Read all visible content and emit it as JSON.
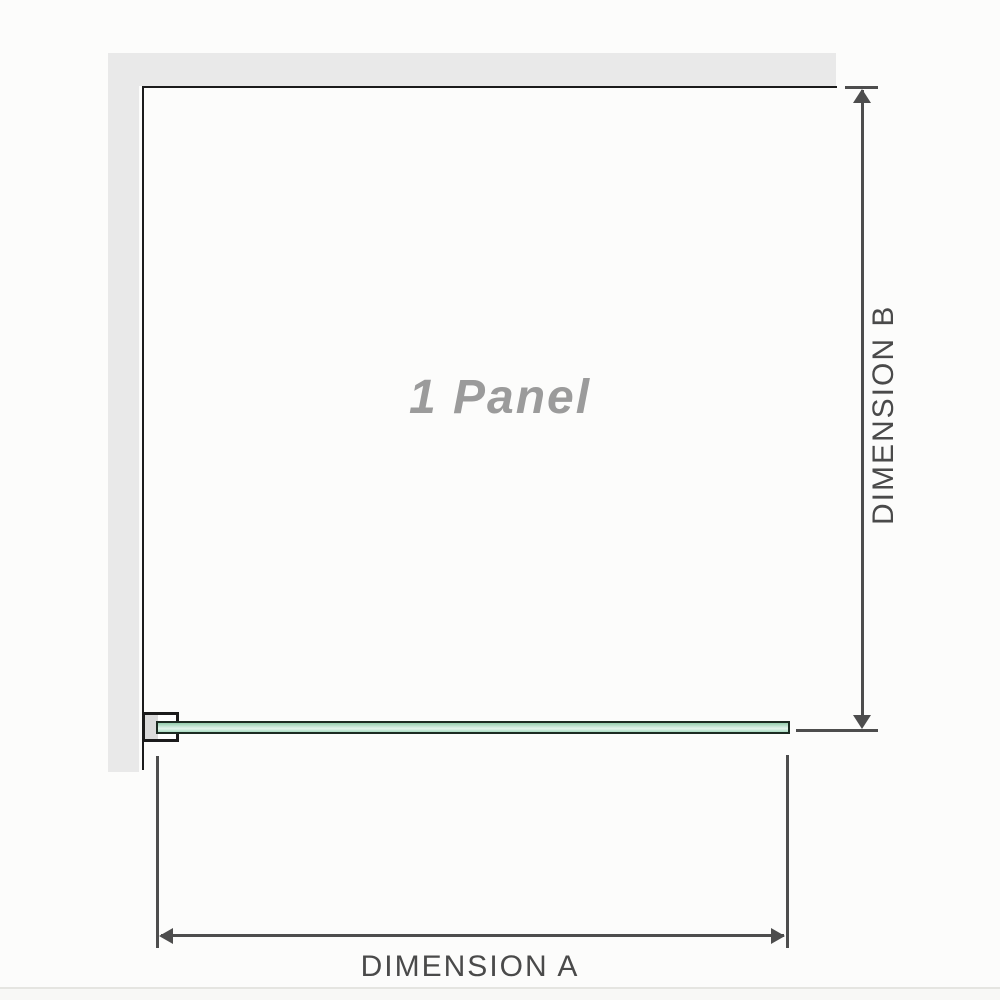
{
  "diagram": {
    "title": "1 Panel",
    "panel_label": "1 Panel",
    "dimension_a_label": "DIMENSION A",
    "dimension_b_label": "DIMENSION B"
  },
  "colors": {
    "background": "#fcfcfb",
    "wall": "#e9e9e9",
    "outline": "#1b1b1b",
    "bracket_channel": "#dbdbdb",
    "glass_border": "#1c2b22",
    "glass_green_dark": "#94ceac",
    "glass_green_light": "#e4f5ec",
    "dimension": "#4d4d4d",
    "label_text": "#4a4a4a",
    "panel_text": "#9b9b9b",
    "separator": "#e5e5e1"
  }
}
